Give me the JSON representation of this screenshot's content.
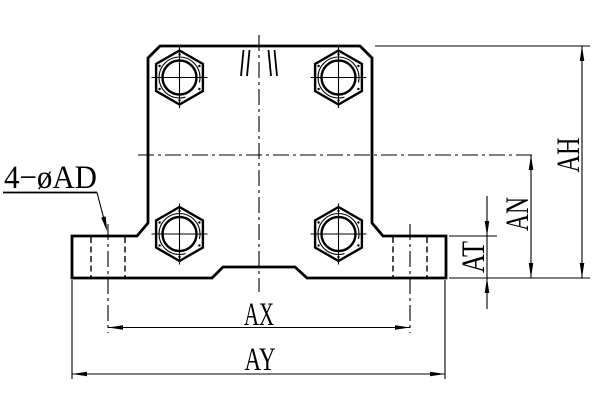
{
  "drawing": {
    "kind": "engineering-drawing",
    "view": "front-view-flanged-shaft-support",
    "colors": {
      "line": "#000000",
      "background": "#ffffff"
    },
    "labels": {
      "callout": "4−øAD",
      "dims": {
        "ah": "AH",
        "an": "AN",
        "at": "AT",
        "ax": "AX",
        "ay": "AY"
      }
    }
  }
}
